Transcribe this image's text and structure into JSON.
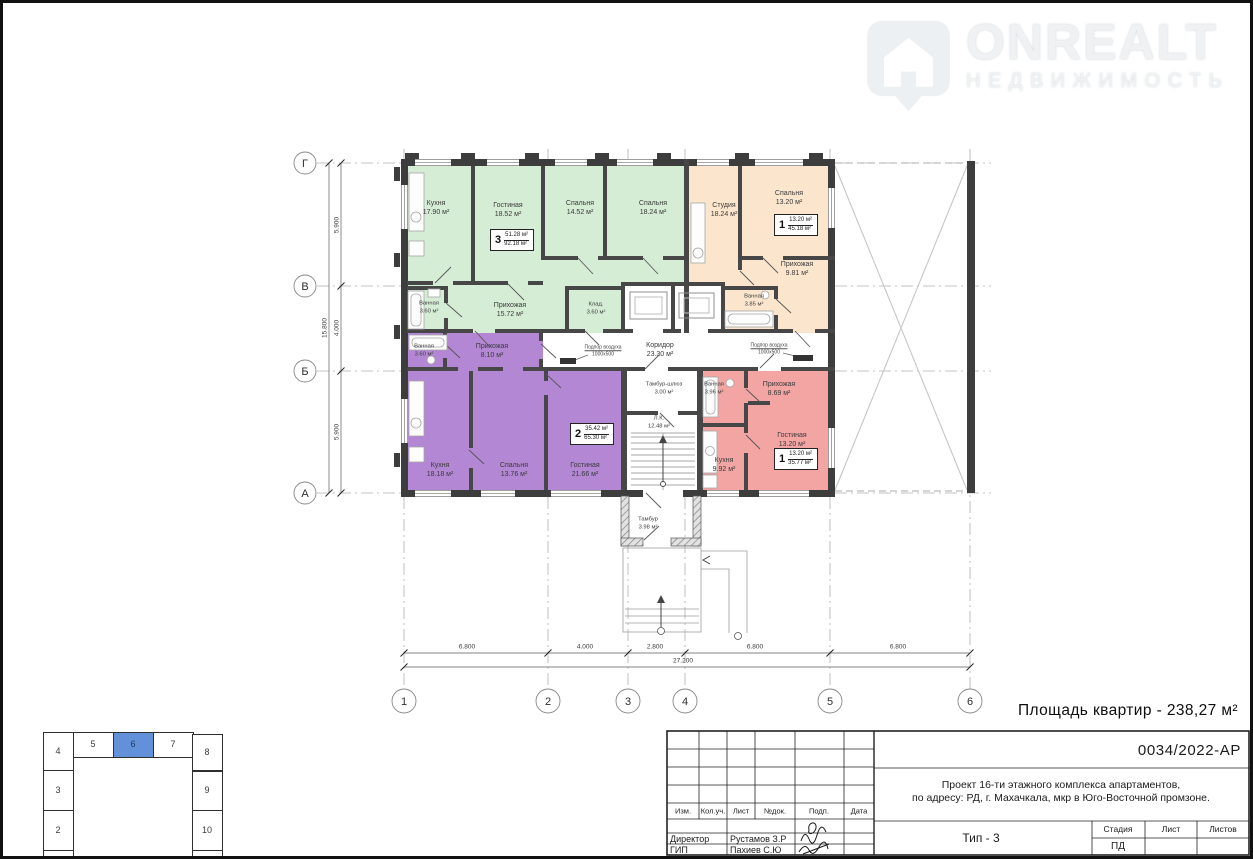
{
  "logo": {
    "brand": "ONREALT",
    "subtitle": "НЕДВИЖИМОСТЬ"
  },
  "summary": {
    "area_text": "Площадь квартир - 238,27 м²"
  },
  "grid": {
    "cols": [
      "1",
      "2",
      "3",
      "4",
      "5",
      "6"
    ],
    "rows": [
      "Г",
      "В",
      "Б",
      "А"
    ]
  },
  "dims": {
    "bottom": [
      "6.800",
      "4.000",
      "2.800",
      "6.800",
      "6.800"
    ],
    "bottom_total": "27.200",
    "left": [
      "5.900",
      "4.000",
      "5.900"
    ],
    "left_total": "15.800"
  },
  "colors": {
    "apt_green": "#d6edd5",
    "apt_peach": "#fbe6cd",
    "apt_purple": "#b487d5",
    "apt_pink": "#f2a5a3",
    "keyplan_highlight": "#6290d9"
  },
  "rooms": [
    {
      "name": "Кухня",
      "area": "17.90 м²"
    },
    {
      "name": "Гостиная",
      "area": "18.52 м²"
    },
    {
      "name": "Спальня",
      "area": "14.52 м²"
    },
    {
      "name": "Спальня",
      "area": "18.24 м²"
    },
    {
      "name": "Ванная",
      "area": "3.60 м²"
    },
    {
      "name": "Прихожая",
      "area": "15.72 м²"
    },
    {
      "name": "Клад.",
      "area": "3.60 м²"
    },
    {
      "name": "Студия",
      "area": "18.24 м²"
    },
    {
      "name": "Спальня",
      "area": "13.20 м²"
    },
    {
      "name": "Прихожая",
      "area": "9.81 м²"
    },
    {
      "name": "Ванная",
      "area": "3.85 м²"
    },
    {
      "name": "Ванная",
      "area": "3.60 м²"
    },
    {
      "name": "Прихожая",
      "area": "8.10 м²"
    },
    {
      "name": "Кухня",
      "area": "18.18 м²"
    },
    {
      "name": "Спальня",
      "area": "13.76 м²"
    },
    {
      "name": "Гостиная",
      "area": "21.66 м²"
    },
    {
      "name": "Ванная",
      "area": "3.96 м²"
    },
    {
      "name": "Прихожая",
      "area": "8.69 м²"
    },
    {
      "name": "Кухня",
      "area": "9.92 м²"
    },
    {
      "name": "Гостиная",
      "area": "13.20 м²"
    },
    {
      "name": "Коридор",
      "area": "23.30 м²"
    },
    {
      "name": "Тамбур-шлюз",
      "area": "3.00 м²"
    },
    {
      "name": "Л.К.",
      "area": "12.48 м²"
    },
    {
      "name": "Тамбур",
      "area": "3.98 м²"
    }
  ],
  "stamps": [
    {
      "num": "3",
      "living": "51.28 м²",
      "total": "92.18 м²"
    },
    {
      "num": "1",
      "living": "13.20 м²",
      "total": "45.18 м²"
    },
    {
      "num": "2",
      "living": "35.42 м²",
      "total": "65.30 м²"
    },
    {
      "num": "1",
      "living": "13.20 м²",
      "total": "35.77 м²"
    }
  ],
  "notes": {
    "vent_line1": "Подпор воздуха",
    "vent_line2": "1000х500"
  },
  "titleblock": {
    "doc_no": "0034/2022-АР",
    "desc1": "Проект 16-ти этажного комплекса апартаментов,",
    "desc2": "по адресу: РД, г. Махачкала, мкр в Юго-Восточной промзоне.",
    "type": "Тип - 3",
    "cols": [
      "Изм.",
      "Кол.уч.",
      "Лист",
      "№док.",
      "Подп.",
      "Дата"
    ],
    "stage_h": "Стадия",
    "sheet_h": "Лист",
    "sheets_h": "Листов",
    "stage": "ПД",
    "role1": "Директор",
    "name1": "Рустамов З.Р",
    "role2": "ГИП",
    "name2": "Пахиев С.Ю"
  },
  "keyplan": {
    "labels": [
      "4",
      "5",
      "6",
      "7",
      "8",
      "3",
      "2",
      "9",
      "10"
    ]
  }
}
